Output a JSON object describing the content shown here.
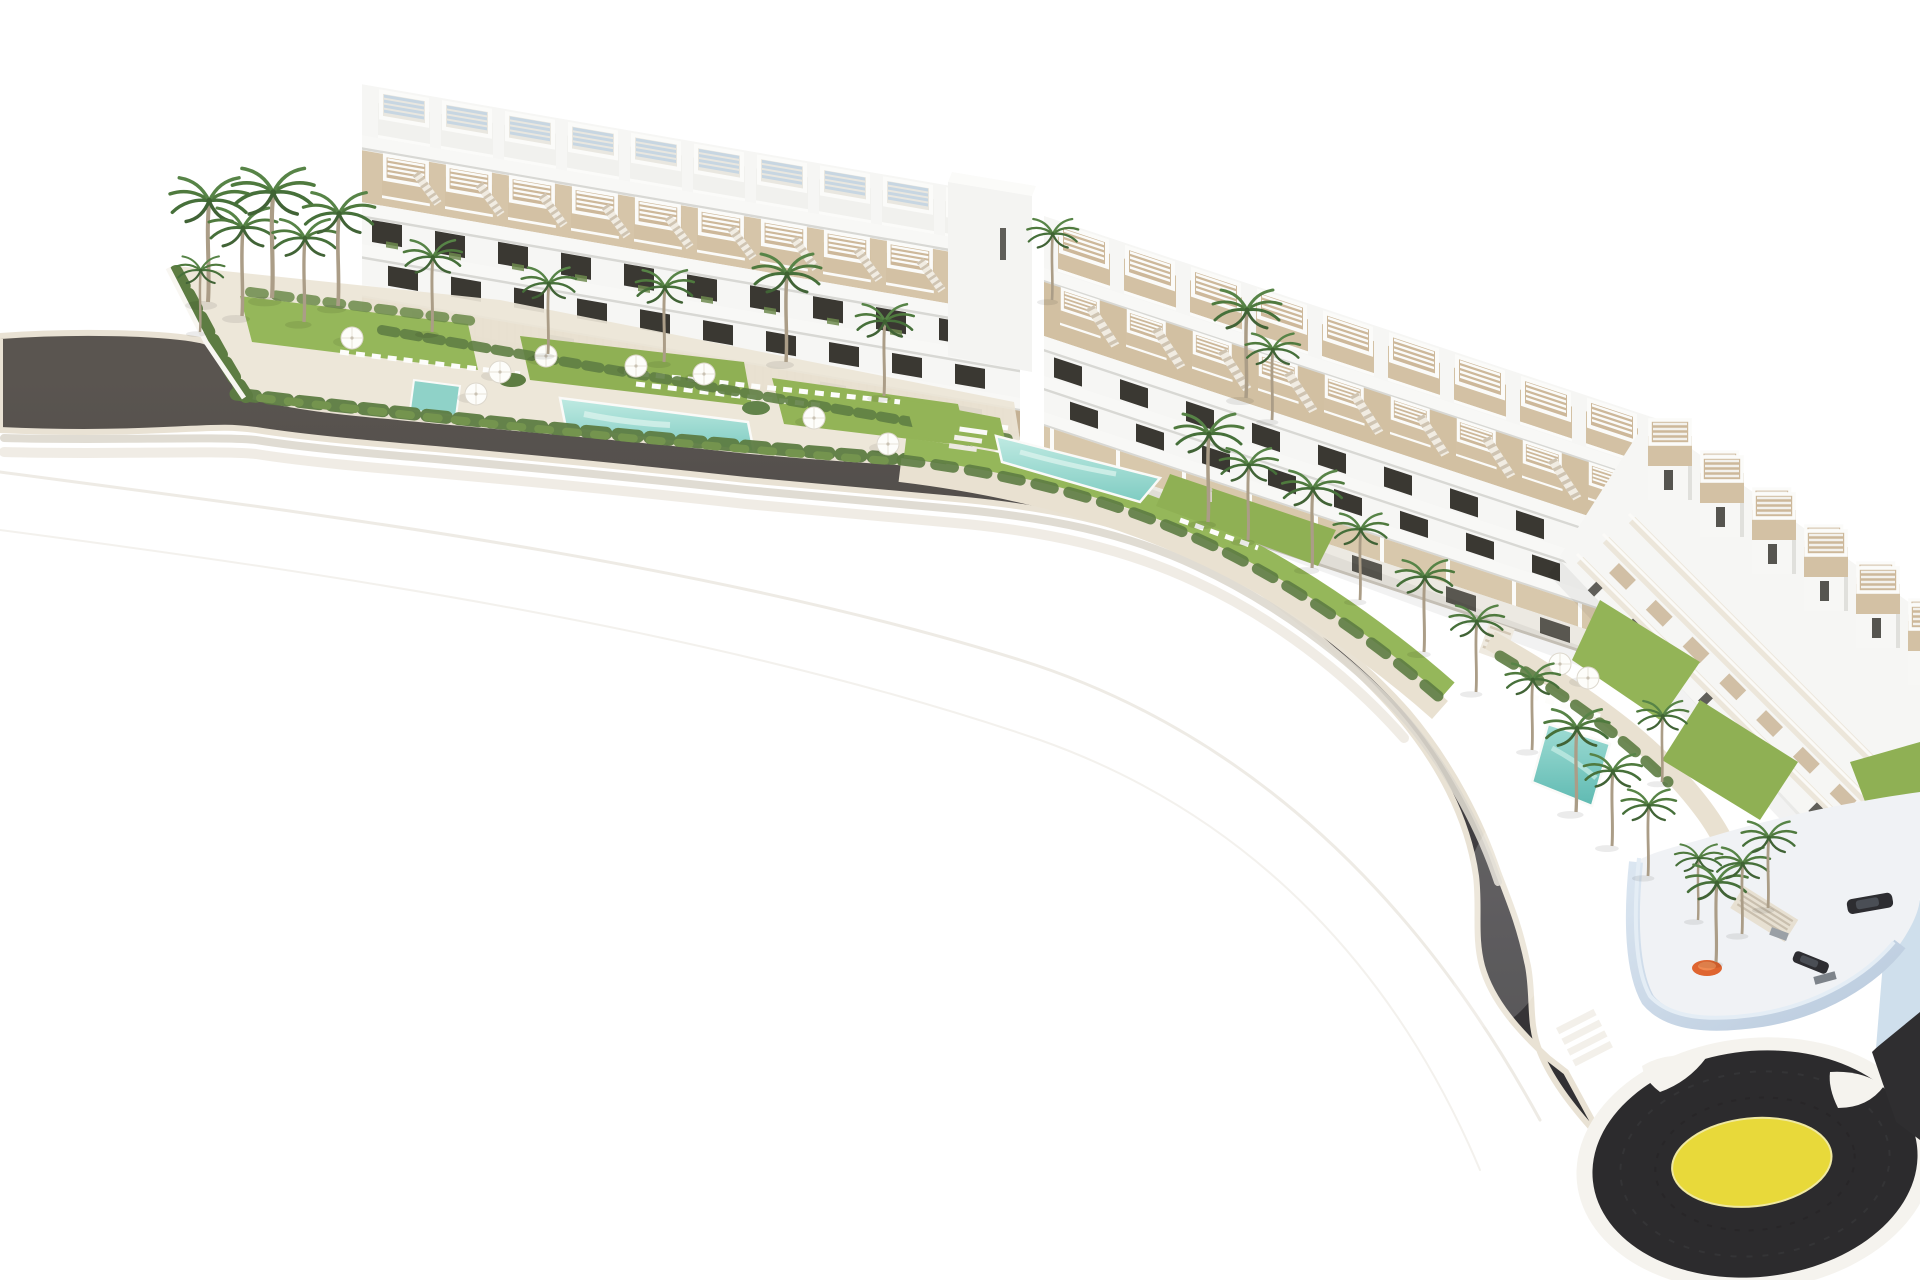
{
  "scene": {
    "type": "aerial-architectural-render",
    "description": "Aerial 3D rendering of a white terraced residential complex of three stepped apartment blocks with roof pergolas, gardens, palm trees and swimming pools, fronted by a dark curved road that ends in a roundabout with a yellow painted center",
    "blocks": [
      {
        "id": "left-block",
        "visible_roof_units": 10
      },
      {
        "id": "middle-block",
        "visible_roof_units": 9
      },
      {
        "id": "right-block",
        "visible_roof_units": 13
      }
    ],
    "pools": [
      "left-garden-main-pool",
      "left-garden-lap-pool",
      "middle-garden-pool",
      "right-garden-pool"
    ],
    "roundabout": {
      "present": true,
      "center_marking": "yellow-disc",
      "islands": 2
    },
    "vehicles_on_terrace": 2
  },
  "colors": {
    "background": "#ffffff",
    "road_light": "#5a5550",
    "road_mid": "#454244",
    "road_dark": "#302f32",
    "curb": "#e9e2d4",
    "roundabout_asphalt": "#2c2b2d",
    "roundabout_center": "#e8d93a",
    "island": "#f5f3ee",
    "building_white": "#f6f6f4",
    "building_shadow": "#dededa",
    "window_dark": "#3a3832",
    "deck_tan": "#d3c1a4",
    "stone_wall": "#c4b194",
    "lawn": "#95b75a",
    "bush": "#5d7c42",
    "palm": "#4f7a3e",
    "palm_trunk": "#ab9d87",
    "pool_light": "#bfeae2",
    "pool_deep": "#7fccc2",
    "podium_wall": "#b9cadd",
    "podium_deck": "#f0f2f5",
    "car": "#2d2d31",
    "accent_orange": "#df6530"
  }
}
